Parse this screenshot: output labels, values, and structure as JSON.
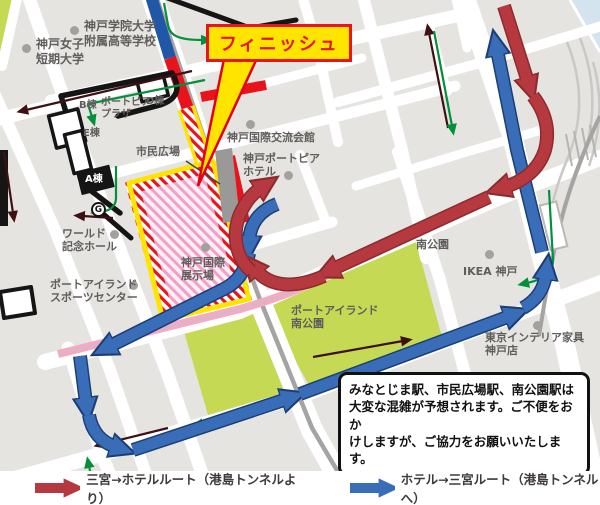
{
  "map": {
    "finish_callout": {
      "text": "フィニッシュ"
    },
    "labels": [
      {
        "id": "kobe-womens-college",
        "text": "神戸女子\n短期大学"
      },
      {
        "id": "kobe-gakuin-highschool",
        "text": "神戸学院大学\n附属高等学校"
      },
      {
        "id": "b-wing",
        "text": "B棟"
      },
      {
        "id": "portopia-plaza",
        "text": "ポートピア\nプラザ"
      },
      {
        "id": "d-wing",
        "text": "D棟"
      },
      {
        "id": "e-wing",
        "text": "E棟"
      },
      {
        "id": "a-wing",
        "text": "A棟"
      },
      {
        "id": "gate-g",
        "text": "G"
      },
      {
        "id": "shimin-hiroba",
        "text": "市民広場"
      },
      {
        "id": "kokusai-koryu-kaikan",
        "text": "神戸国際交流会館"
      },
      {
        "id": "portopia-hotel",
        "text": "神戸ポートピア\nホテル"
      },
      {
        "id": "world-memorial-hall",
        "text": "ワールド\n記念ホール"
      },
      {
        "id": "kokusai-tenjijo",
        "text": "神戸国際\n展示場"
      },
      {
        "id": "sports-center",
        "text": "ポートアイランド\nスポーツセンター"
      },
      {
        "id": "minami-koen",
        "text": "南公園"
      },
      {
        "id": "ikea-kobe",
        "text": "IKEA 神戸"
      },
      {
        "id": "pi-minami-koen",
        "text": "ポートアイランド\n南公園"
      },
      {
        "id": "tokyo-interior",
        "text": "東京インテリア家具\n神戸店"
      }
    ],
    "notice": {
      "lines": [
        "みなとじま駅、市民広場駅、南公園駅は",
        "大変な混雑が予想されます。ご不便をおか",
        "けしますが、ご協力をお願いいたします。"
      ]
    },
    "colors": {
      "route_red": "#b5393e",
      "route_red_outline": "#8c2b2f",
      "route_blue": "#3a6db8",
      "route_blue_outline": "#1b3e75",
      "course_red": "#e8131b",
      "course_blue": "#2157a7",
      "park_green": "#c5d955",
      "pink_line": "#f5a9c5",
      "finish_yellow": "#ffe400",
      "walk_green": "#00913a",
      "walk_maroon": "#3f1013"
    }
  },
  "legend": {
    "red_label": "三宮→ホテルルート（港島トンネルより）",
    "blue_label": "ホテル→三宮ルート（港島トンネルへ）"
  }
}
